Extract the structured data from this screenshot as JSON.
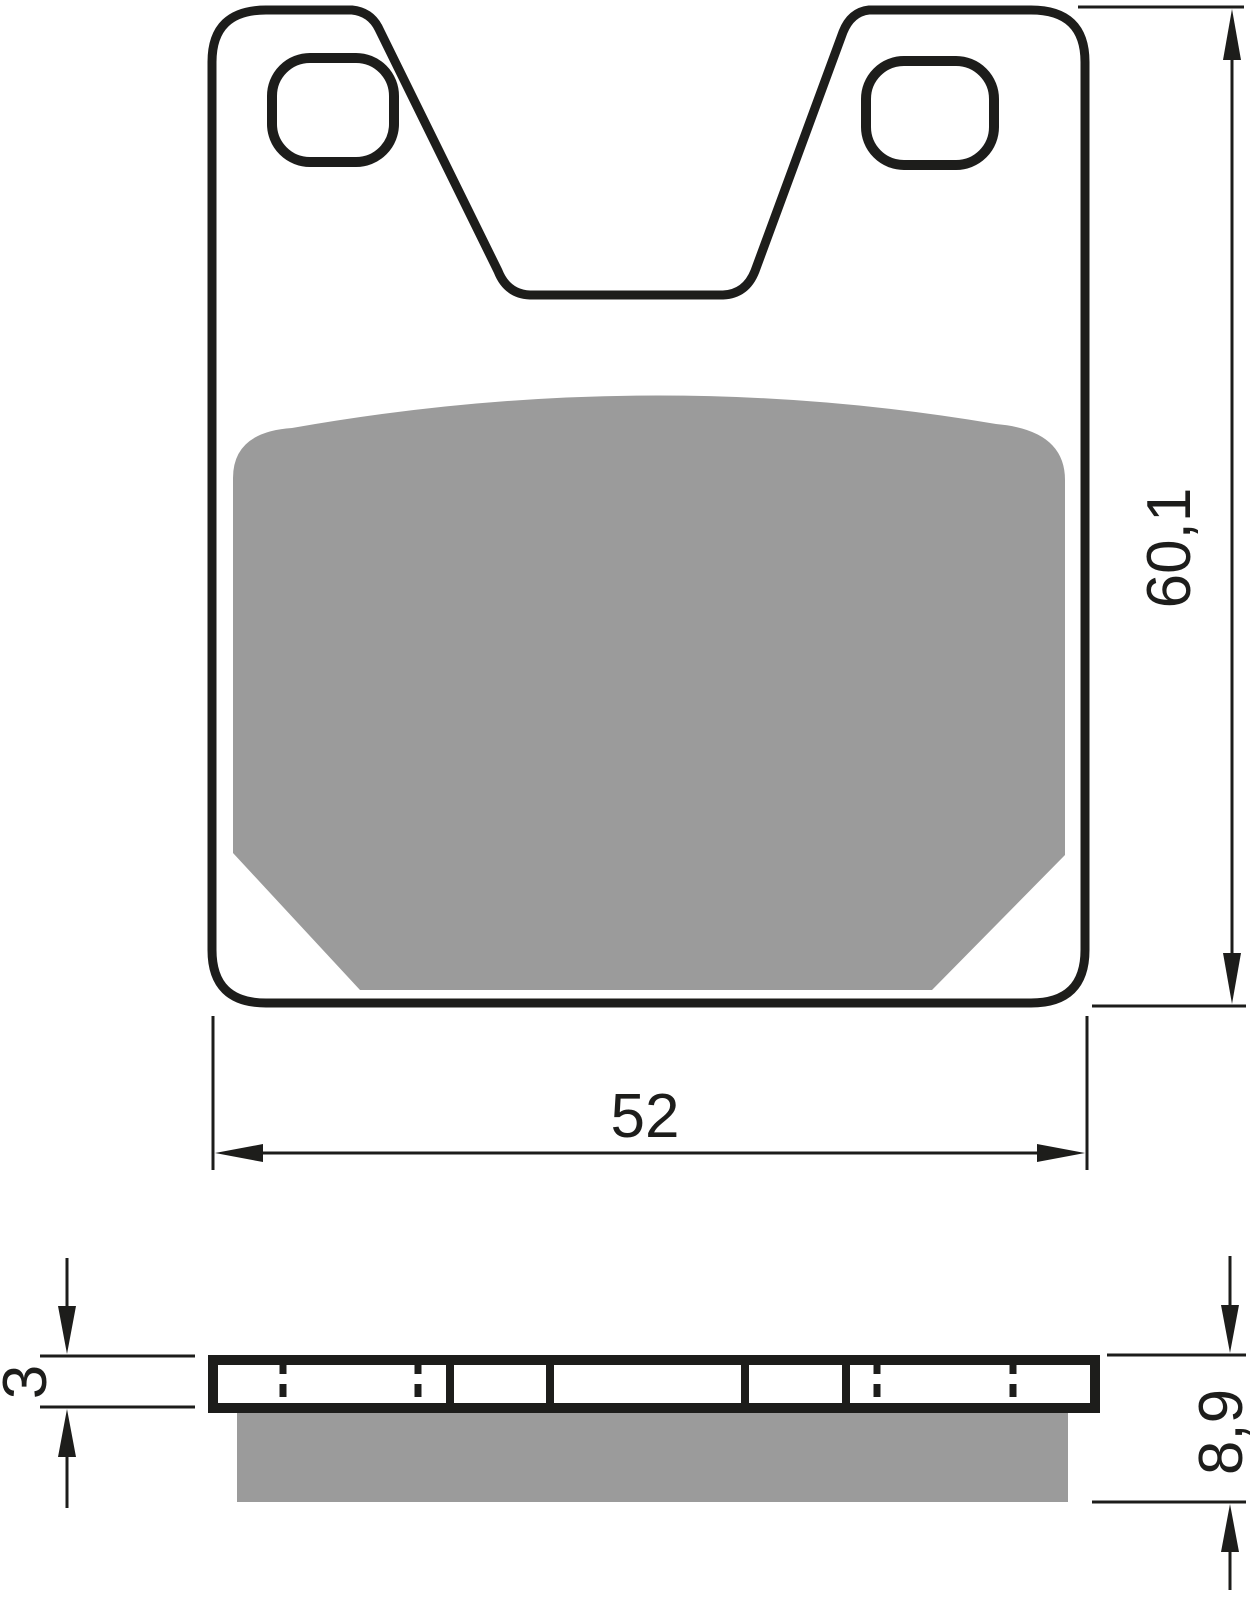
{
  "drawing": {
    "subject": "brake-pad-technical-drawing",
    "colors": {
      "line": "#1d1d1b",
      "friction_gray": "#9b9b9b",
      "background": "#ffffff"
    },
    "dimensions": {
      "pad_width": {
        "label": "52"
      },
      "pad_height": {
        "label": "60,1"
      },
      "backplate_thickness": {
        "label": "3"
      },
      "total_thickness": {
        "label": "8,9"
      }
    }
  }
}
